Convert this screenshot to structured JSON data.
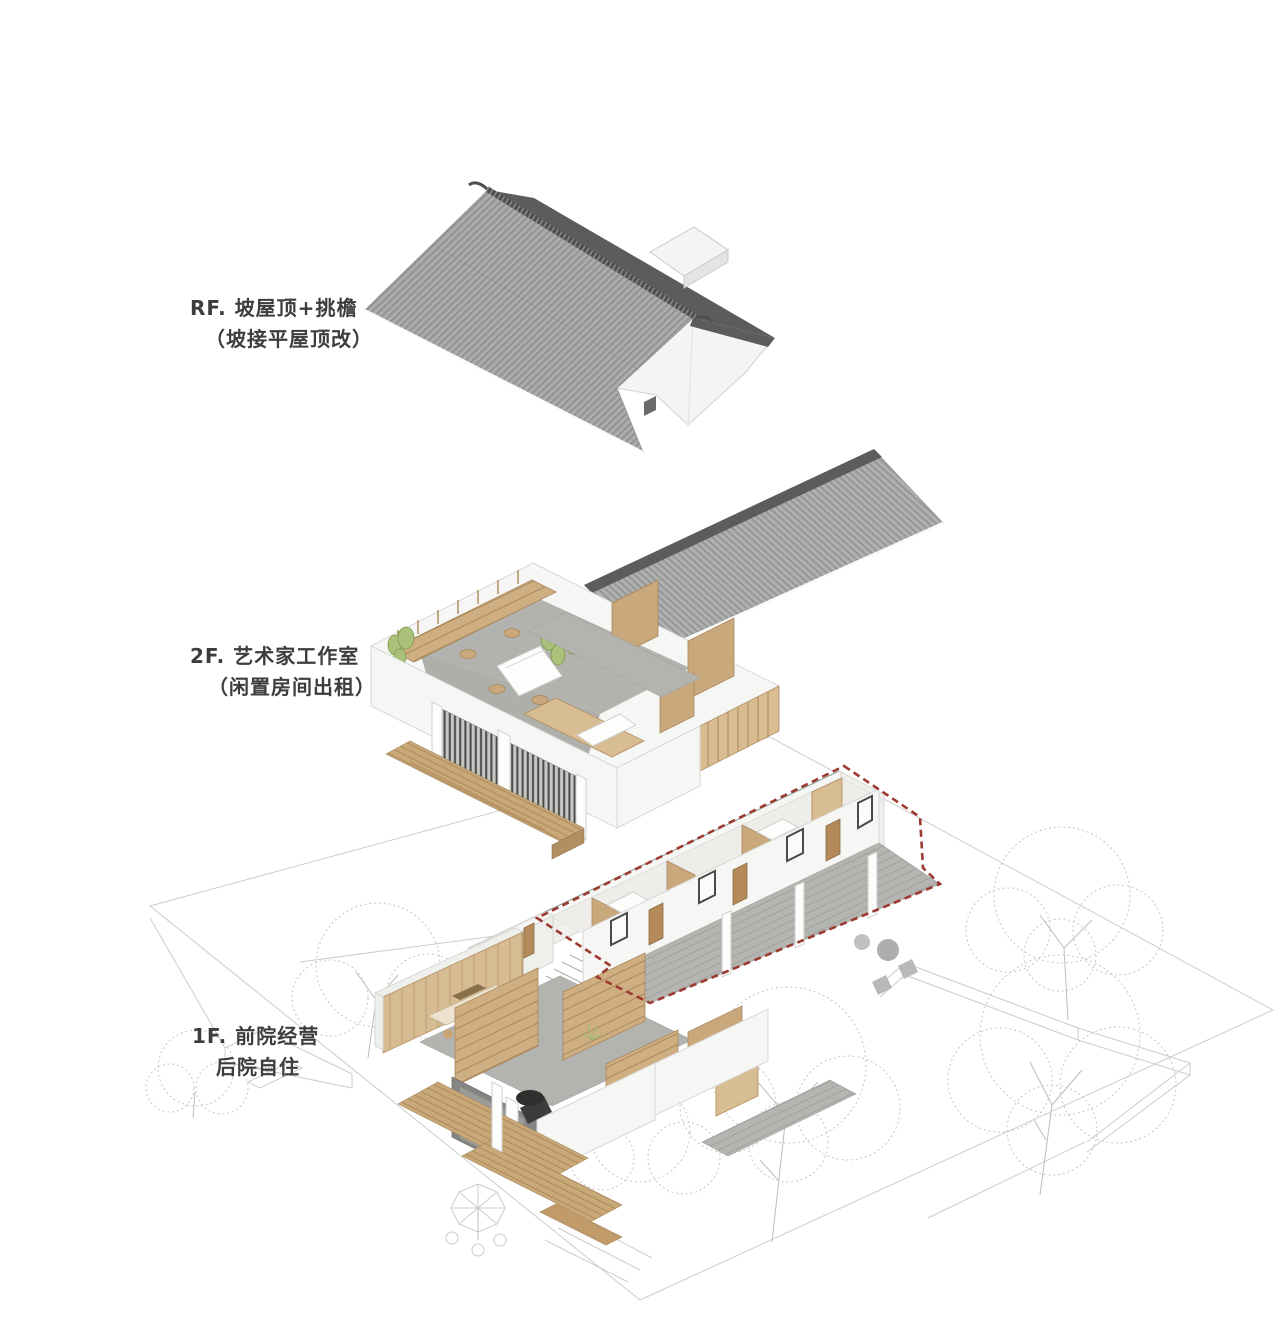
{
  "diagram": {
    "type": "exploded-axonometric-architecture",
    "background": "#ffffff"
  },
  "levels": [
    {
      "id": "RF",
      "name": "pitched-roof",
      "label_line1": "RF. 坡屋顶+挑檐",
      "label_line2": "（坡接平屋顶改）"
    },
    {
      "id": "2F",
      "name": "artist-studio-floor",
      "label_line1": "2F. 艺术家工作室",
      "label_line2": "（闲置房间出租）"
    },
    {
      "id": "1F",
      "name": "ground-floor",
      "label_line1": "1F. 前院经营",
      "label_line2": "后院自住"
    }
  ],
  "colors": {
    "roof_tile_light": "#a5a5a3",
    "roof_tile_dark": "#5c5c5a",
    "wall_white": "#f6f6f4",
    "wood": "#c9a87c",
    "wood_light": "#d8bd93",
    "floor_concrete": "#b3b3b0",
    "railing_dark": "#4a4a48",
    "plant_green": "#a9c178",
    "outline_red": "#9c3a32",
    "sketch_gray": "#cccccb",
    "label_text": "#3d3d3d"
  }
}
